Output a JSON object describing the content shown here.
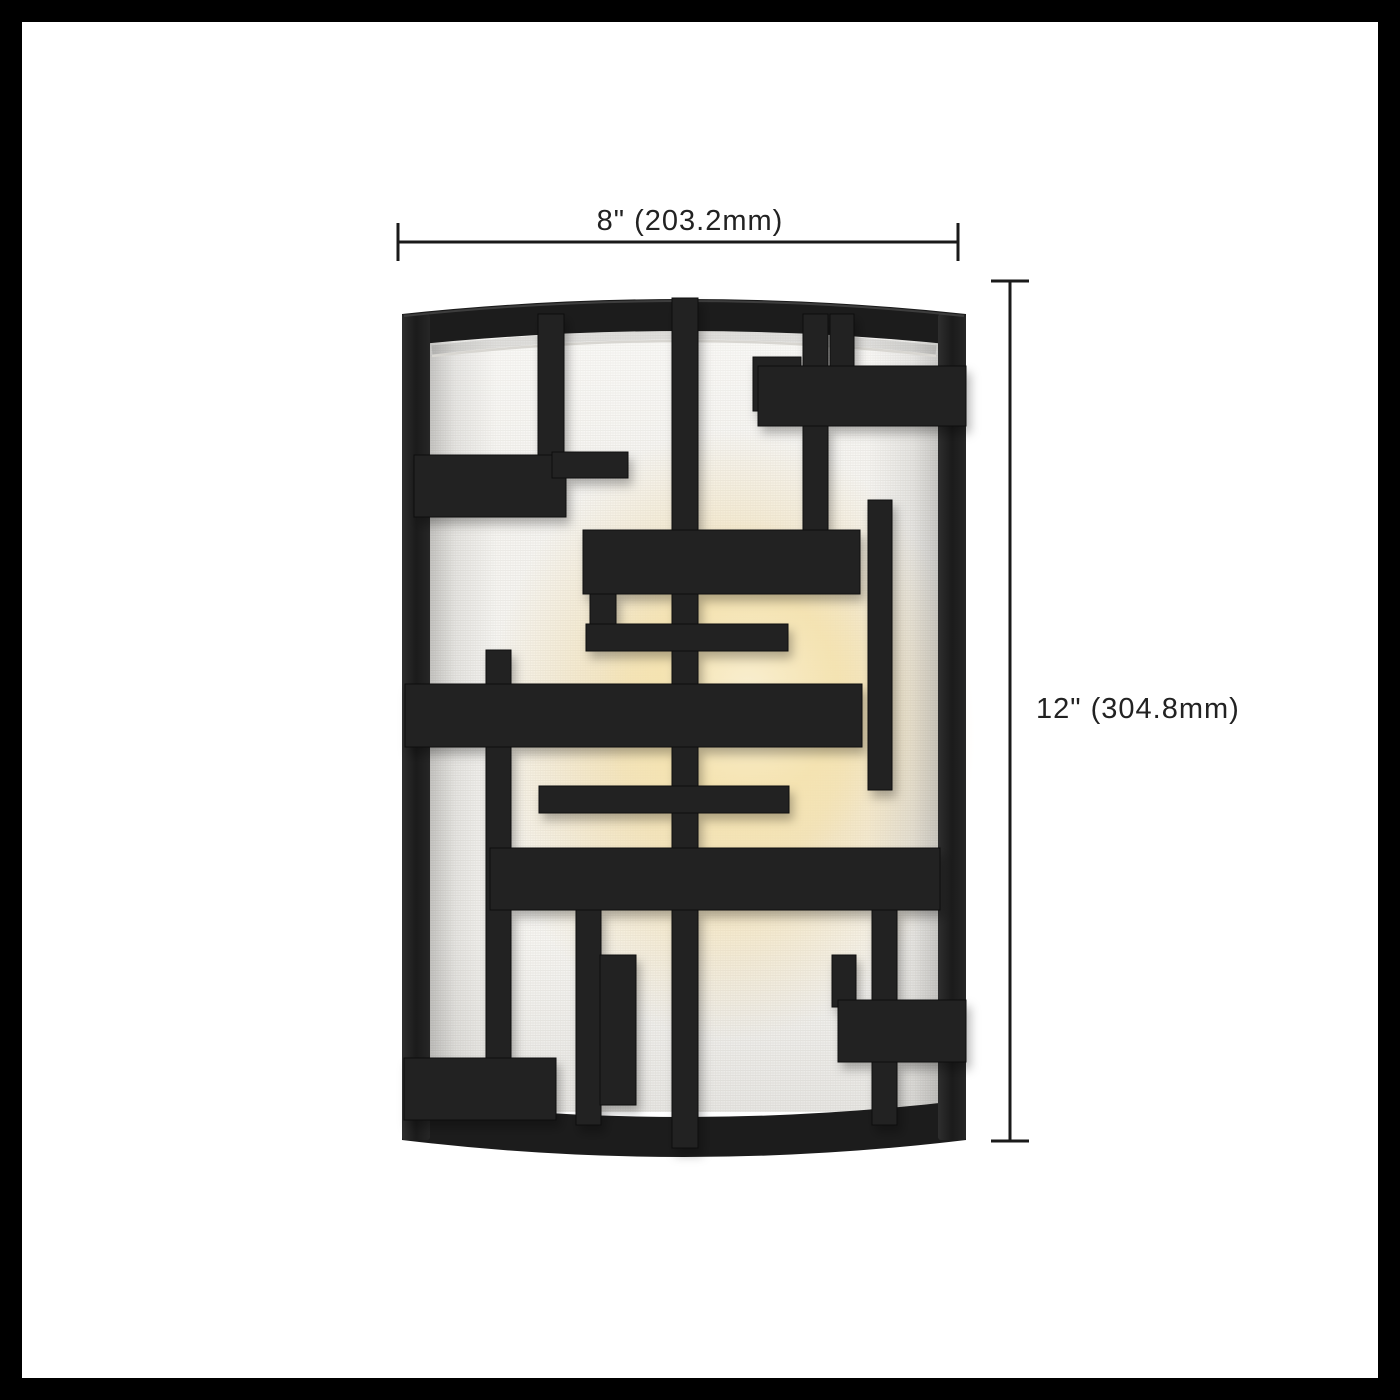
{
  "dimensions": {
    "width": {
      "label": "8\" (203.2mm)",
      "inches": 8,
      "mm": 203.2
    },
    "height": {
      "label": "12\" (304.8mm)",
      "inches": 12,
      "mm": 304.8
    }
  },
  "colors": {
    "background": "#ffffff",
    "border": "#000000",
    "fixture_black": "#212121",
    "fixture_frame": "#1c1c1c",
    "shade_white": "#f7f6f3",
    "shade_weave_line": "#e8e6e1",
    "glow_warm": "#f4e0a8",
    "glow_core": "#f8eccb",
    "dimension_line": "#1a1a1a",
    "dimension_text": "#222222"
  }
}
